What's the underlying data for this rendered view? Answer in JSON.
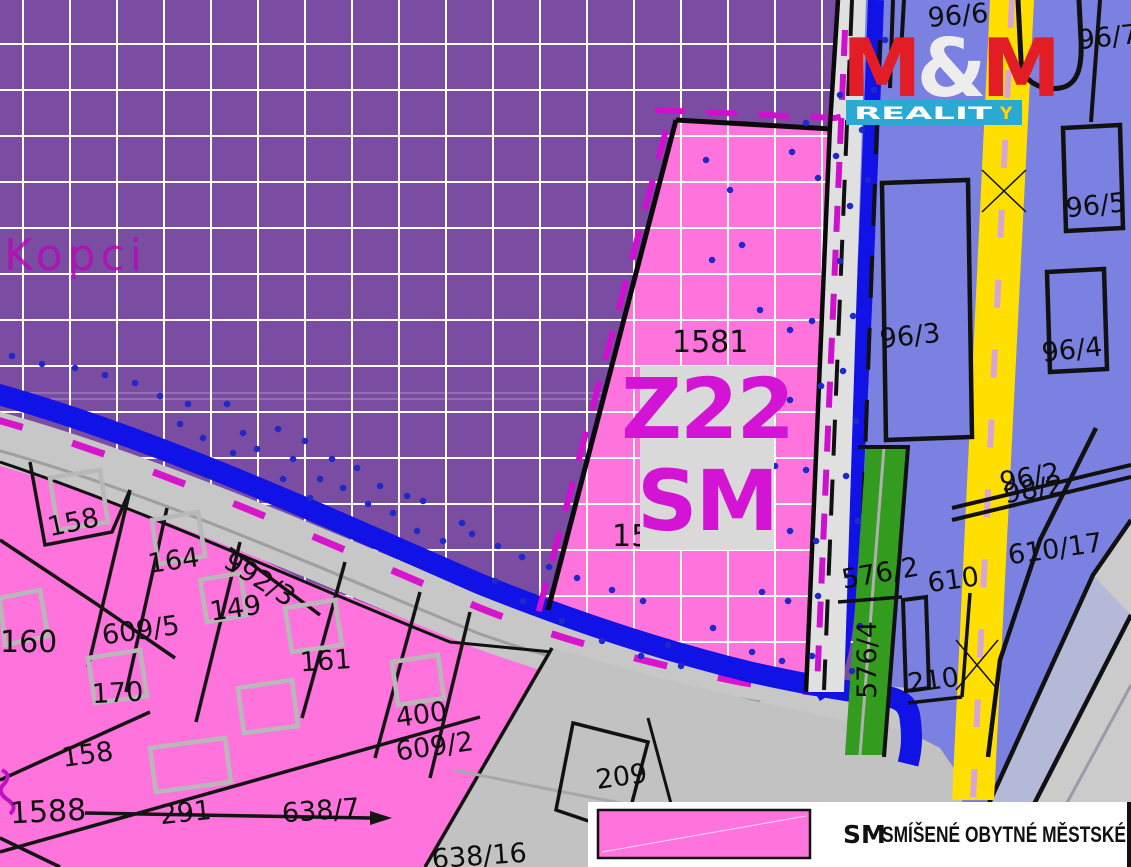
{
  "map": {
    "place_label": "Kopci",
    "zone": {
      "code": "Z22",
      "type": "SM"
    },
    "labels": {
      "l1581": "1581",
      "l15": "15",
      "p96_6": "96/6",
      "p96_7": "96/7",
      "p96_5": "96/5",
      "p96_3": "96/3",
      "p96_4": "96/4",
      "p96_2": "96/2",
      "p98_2": "98/2",
      "p610_17": "610/17",
      "p610": "610",
      "p210": "210",
      "p576_2": "576/2",
      "p576_4": "576/4",
      "p158a": "158",
      "p164": "164",
      "p992_3": "992/3",
      "p149": "149",
      "p609_5": "609/5",
      "p160": "160",
      "p161": "161",
      "p170": "170",
      "p400": "400",
      "p609_2": "609/2",
      "p158b": "158",
      "p1588": "1588",
      "p291": "291",
      "p638_7": "638/7",
      "p209": "209",
      "p638_16": "638/16"
    },
    "colors": {
      "purple_zone": "#7a4da3",
      "pink_zone": "#ff73dc",
      "blue_zone": "#7b81e0",
      "road_blue": "#1012e6",
      "road_yellow": "#ffdf00",
      "green_zone": "#339b1e",
      "magenta_boundary": "#cf10cf",
      "zone_text": "#d414d4"
    }
  },
  "logo": {
    "m1": "M",
    "amp": "&",
    "m2": "M",
    "reality_main": "REALIT",
    "reality_y": "Y"
  },
  "legend": {
    "code": "SM",
    "label": "SMÍŠENÉ OBYTNÉ MĚSTSKÉ",
    "swatch_color": "#ff73dc"
  }
}
